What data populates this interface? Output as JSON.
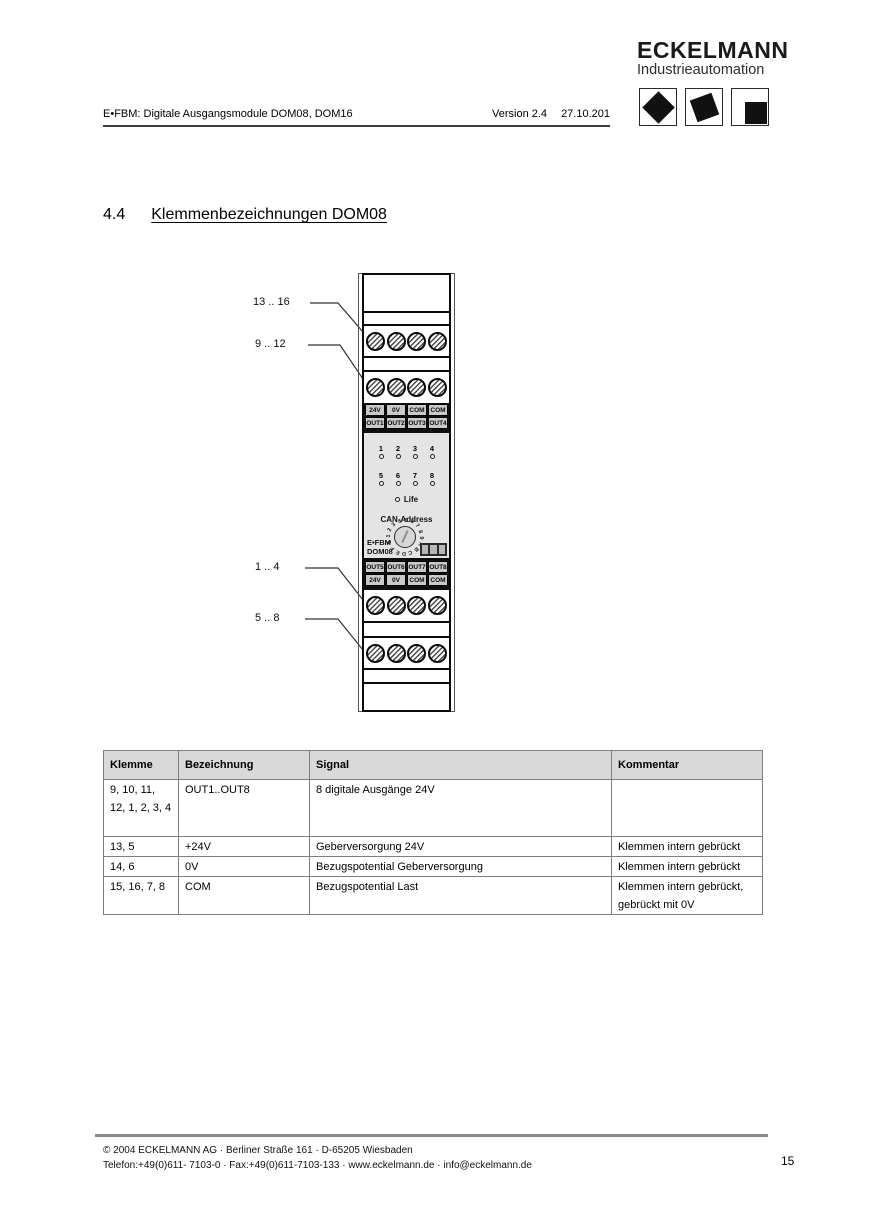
{
  "header": {
    "doc_title": "E•FBM: Digitale Ausgangsmodule DOM08, DOM16",
    "version": "Version 2.4",
    "date": "27.10.201"
  },
  "logo": {
    "brand": "ECKELMANN",
    "subtitle": "Industrieautomation"
  },
  "section": {
    "number": "4.4",
    "title": "Klemmenbezeichnungen DOM08"
  },
  "diagram": {
    "callouts": [
      {
        "label": "13 .. 16"
      },
      {
        "label": "9 .. 12"
      },
      {
        "label": "1 .. 4"
      },
      {
        "label": "5 .. 8"
      }
    ],
    "module": {
      "top_labels_row1": [
        "24V",
        "0V",
        "COM",
        "COM"
      ],
      "top_labels_row2": [
        "OUT1",
        "OUT2",
        "OUT3",
        "OUT4"
      ],
      "led_row1": [
        "1",
        "2",
        "3",
        "4"
      ],
      "led_row2": [
        "5",
        "6",
        "7",
        "8"
      ],
      "life_label": "Life",
      "can_address_label": "CAN-Address",
      "dial_chars": "0123456789ABCDEF",
      "model_line1": "E•FBM",
      "model_line2": "DOM08",
      "bottom_labels_row1": [
        "OUT5",
        "OUT6",
        "OUT7",
        "OUT8"
      ],
      "bottom_labels_row2": [
        "24V",
        "0V",
        "COM",
        "COM"
      ]
    }
  },
  "table": {
    "headers": [
      "Klemme",
      "Bezeichnung",
      "Signal",
      "Kommentar"
    ],
    "rows": [
      [
        "9, 10, 11, 12, 1, 2, 3, 4",
        "OUT1..OUT8",
        "8 digitale Ausgänge 24V",
        ""
      ],
      [
        "13, 5",
        "+24V",
        "Geberversorgung 24V",
        "Klemmen intern gebrückt"
      ],
      [
        "14, 6",
        "0V",
        "Bezugspotential Geberversorgung",
        "Klemmen intern gebrückt"
      ],
      [
        "15, 16, 7, 8",
        "COM",
        "Bezugspotential Last",
        "Klemmen intern gebrückt, gebrückt mit 0V"
      ]
    ]
  },
  "footer": {
    "line1": "© 2004 ECKELMANN AG · Berliner Straße 161 · D-65205 Wiesbaden",
    "line2": "Telefon:+49(0)611- 7103-0 · Fax:+49(0)611-7103-133 · www.eckelmann.de · info@eckelmann.de",
    "page_number": "15"
  },
  "colors": {
    "table_header_bg": "#d9d9d9",
    "module_panel_bg": "#e4e4e4",
    "terminal_label_bg": "#c9c9c9",
    "footer_rule": "#8a8a8a",
    "text": "#000000"
  }
}
